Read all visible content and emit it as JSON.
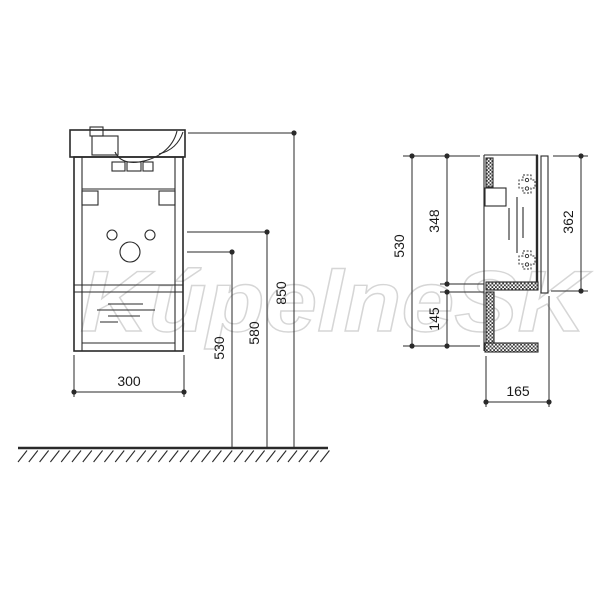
{
  "watermark": {
    "text": "KúpelneSK"
  },
  "colors": {
    "line": "#2a2a2a",
    "watermark": "#d2d2d2",
    "background": "#ffffff"
  },
  "dims": {
    "front_width": "300",
    "front_h530": "530",
    "front_h580": "580",
    "front_h850": "850",
    "side_h530": "530",
    "side_348": "348",
    "side_145": "145",
    "side_362": "362",
    "side_depth": "165"
  }
}
